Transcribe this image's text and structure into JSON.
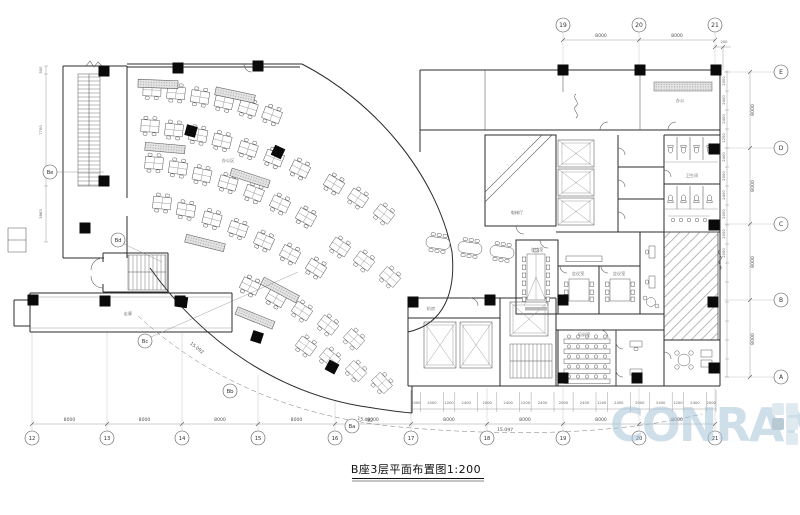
{
  "title": {
    "text": "B座3层平面布置图1:200"
  },
  "watermark": {
    "text": "CONRAN",
    "color": "#a9c6da"
  },
  "colors": {
    "line": "#2b2b2b",
    "column": "#0a0a0a",
    "watermark": "#a9c6da"
  },
  "grid": {
    "top": {
      "labels": [
        "19",
        "20",
        "21"
      ],
      "dims": [
        "8000",
        "8000"
      ],
      "offset": "200"
    },
    "right": {
      "labels": [
        "E",
        "D",
        "C",
        "B",
        "A"
      ],
      "dims": [
        "8000",
        "8000",
        "8000",
        "8000"
      ],
      "fine": [
        "2000",
        "2400",
        "2400",
        "1200",
        "2400",
        "2000",
        "2400",
        "2000",
        "2000",
        "2000"
      ]
    },
    "bottom": {
      "labels": [
        "12",
        "13",
        "14",
        "15",
        "16",
        "17",
        "18",
        "19",
        "20",
        "21"
      ],
      "dims": [
        "8000",
        "8000",
        "8000",
        "8000",
        "8000",
        "8000",
        "8000",
        "8000",
        "8000"
      ],
      "fine": [
        "1000",
        "2400",
        "1200",
        "2400",
        "2000",
        "2400",
        "1200",
        "2400",
        "2000",
        "2400",
        "1200",
        "2400",
        "2000",
        "2400",
        "1200",
        "2400",
        "2000"
      ]
    },
    "curve": {
      "labels": [
        "Ba",
        "Bb",
        "Bc",
        "Bd",
        "Be"
      ],
      "radii": [
        "15.092",
        "15.092",
        "15.097"
      ]
    }
  },
  "stairwell": {
    "dims": [
      "500",
      "7700",
      "3863"
    ]
  },
  "rooms": {
    "corridor": "走廊",
    "lobby": "电梯厅",
    "toilet": "卫生间",
    "conference": "会议室",
    "meeting_a": "会议室",
    "meeting_b": "会议室",
    "training": "培训室",
    "machine": "机房",
    "office": "办公区",
    "office_b": "办公"
  }
}
